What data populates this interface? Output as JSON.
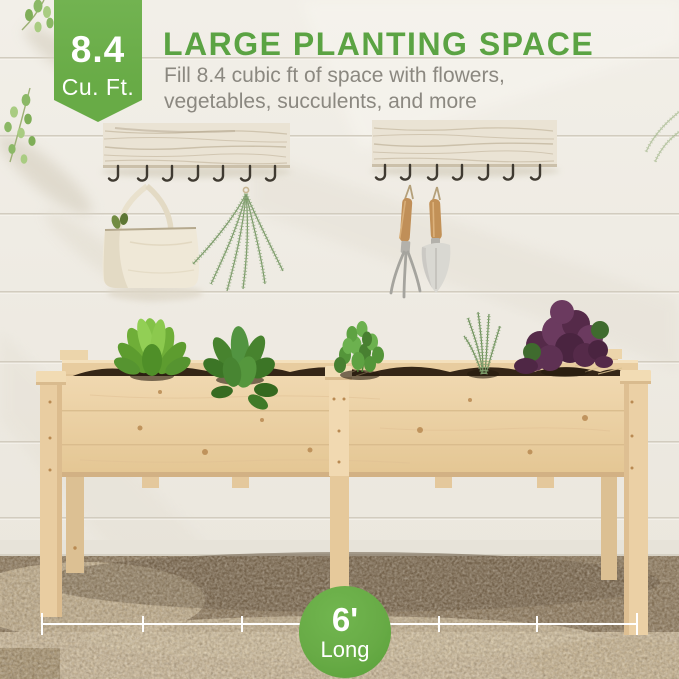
{
  "header": {
    "badge": {
      "value": "8.4",
      "unit": "Cu. Ft."
    },
    "title": "LARGE PLANTING SPACE",
    "subtitle_line1": "Fill 8.4 cubic ft of space with flowers,",
    "subtitle_line2": "vegetables, succulents, and more"
  },
  "dimension_callout": {
    "value": "6'",
    "label": "Long"
  },
  "colors": {
    "brand_green": "#68ab46",
    "title_green": "#5ba343",
    "subtitle_gray": "#8b8880",
    "badge_text": "#ffffff",
    "dimension_line": "#ffffff",
    "wall": "#f0ede6",
    "planter_wood": "#ecd2a9",
    "soil": "#352617",
    "gravel_dark": "#8a775c",
    "gravel_light": "#cdbc9e"
  },
  "scene": {
    "objects": [
      "shiplap-wall",
      "hook-rail-left",
      "hook-rail-right",
      "canvas-tote-bag",
      "dried-herb-bundle",
      "hand-rake",
      "garden-trowel",
      "raised-garden-bed-planter",
      "lettuce-plant",
      "leafy-greens-plant",
      "basil-plant",
      "rosemary-plant",
      "purple-kale-plant",
      "soil",
      "gravel-ground",
      "dimension-line"
    ]
  }
}
